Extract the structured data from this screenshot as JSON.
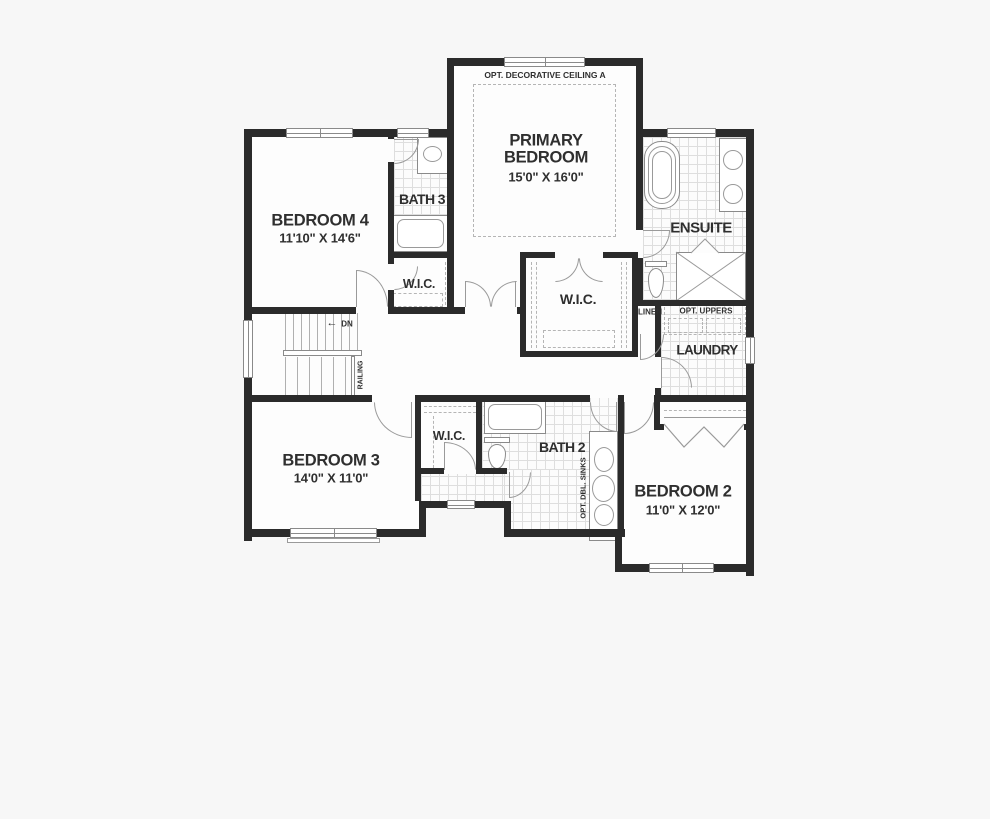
{
  "plan_title": "second floor plan",
  "colors": {
    "background": "#f7f7f7",
    "floor": "#fdfdfd",
    "wall": "#2b2b2b",
    "fixture_line": "#8a8a8a",
    "door_line": "#9a9a9a",
    "tile_line": "#dedede",
    "text": "#2f2f2f"
  },
  "rooms": {
    "primary": {
      "name": "PRIMARY BEDROOM",
      "dims": "15'0\" X 16'0\"",
      "ceiling_note": "OPT. DECORATIVE CEILING A"
    },
    "bedroom4": {
      "name": "BEDROOM 4",
      "dims": "11'10\" X 14'6\""
    },
    "bedroom3": {
      "name": "BEDROOM 3",
      "dims": "14'0\" X 11'0\""
    },
    "bedroom2": {
      "name": "BEDROOM 2",
      "dims": "11'0\" X 12'0\""
    },
    "bath3": {
      "name": "BATH 3"
    },
    "bath2": {
      "name": "BATH 2",
      "option_note": "OPT. DBL. SINKS"
    },
    "ensuite": {
      "name": "ENSUITE"
    },
    "wic_primary": {
      "name": "W.I.C."
    },
    "wic_bedroom4": {
      "name": "W.I.C."
    },
    "wic_bedroom3": {
      "name": "W.I.C."
    },
    "linen": {
      "name": "LINEN"
    },
    "laundry": {
      "name": "LAUNDRY",
      "option_note": "OPT. UPPERS"
    },
    "stairs": {
      "arrow": "←",
      "direction": "DN",
      "railing": "RAILING"
    }
  }
}
